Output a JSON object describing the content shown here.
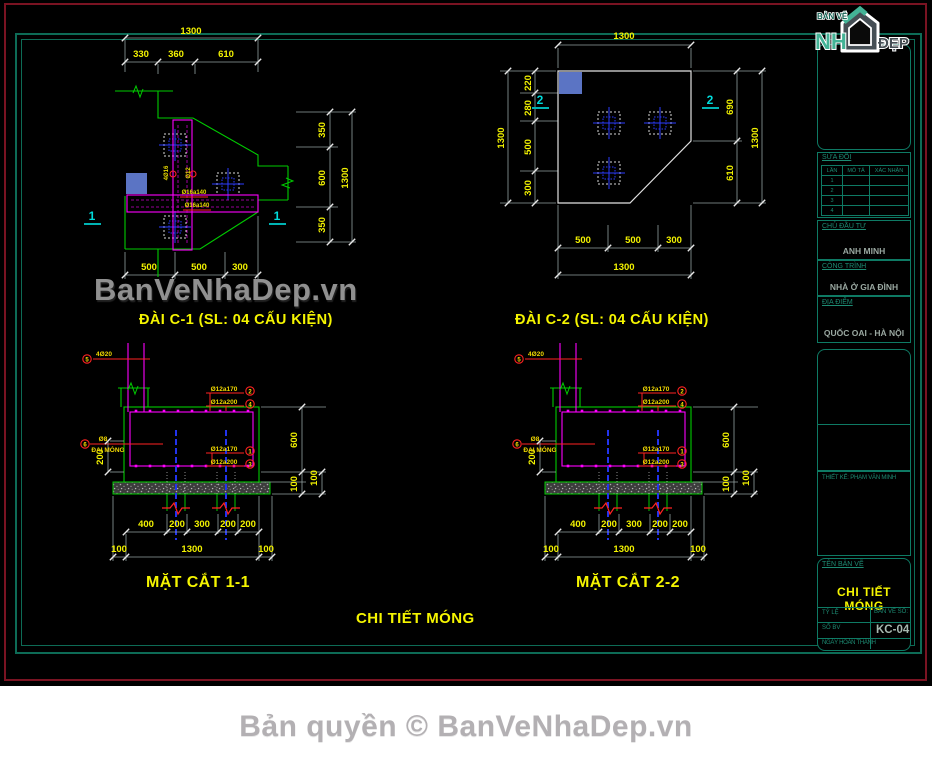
{
  "colors": {
    "line_green": "#00cc00",
    "magenta": "#ff00ff",
    "dim_text_yellow": "#f2f200",
    "cyan_marker": "#00dcdc",
    "blue_fill": "#5b74c4",
    "blue_line": "#2233ee",
    "red_callout": "#ff2222",
    "teal_frame": "#0d6b56",
    "maroon_frame": "#7a1322",
    "white_line": "#e2e2e2",
    "watermark_gray": "#909090"
  },
  "watermark": {
    "text": "BanVeNhaDep.vn"
  },
  "footer": {
    "copyright": "Bản quyền © BanVeNhaDep.vn"
  },
  "logo": {
    "top": "BẢN VẼ",
    "left": "NH",
    "right": "ĐẸP"
  },
  "main_title": "CHI TIẾT MÓNG",
  "c1": {
    "title": "ĐÀI C-1 (SL: 04 CẤU KIỆN)",
    "marker": "1",
    "top_total": "1300",
    "top_chain": [
      "330",
      "360",
      "610"
    ],
    "right_chain": [
      "350",
      "600",
      "350"
    ],
    "right_total": "1300",
    "bottom_chain": [
      "500",
      "500",
      "300"
    ],
    "bar_label_1": "4Ø16",
    "bar_label_2": "Ø12",
    "band_label_1": "Ø16a140",
    "band_label_2": "Ø16a140"
  },
  "c2": {
    "title": "ĐÀI C-2 (SL: 04 CẤU KIỆN)",
    "marker": "2",
    "top_total": "1300",
    "left_chain": [
      "220",
      "280",
      "500",
      "300"
    ],
    "left_total": "1300",
    "right_chain": [
      "690",
      "610"
    ],
    "right_total": "1300",
    "bottom_chain": [
      "500",
      "500",
      "300"
    ],
    "bottom_total": "1300"
  },
  "s11": {
    "title": "MẶT CẮT 1-1",
    "bottom_chain": [
      "400",
      "200",
      "300",
      "200",
      "200"
    ],
    "bottom_totals": [
      "100",
      "1300",
      "100"
    ],
    "left_dim": "200",
    "right_dims": [
      "600",
      "100",
      "100"
    ],
    "callouts_top": [
      {
        "label": "Ø12a170",
        "num": "2"
      },
      {
        "label": "Ø12a200",
        "num": "4"
      }
    ],
    "callouts_bottom": [
      {
        "label": "Ø12a170",
        "num": "1"
      },
      {
        "label": "Ø12a200",
        "num": "3"
      }
    ],
    "column_callout": {
      "num": "5",
      "label": "4Ø20"
    },
    "side_callout": {
      "num": "6",
      "label": "Ø8",
      "label2": "ĐAI MÓNG"
    }
  },
  "s22": {
    "title": "MẶT CẮT 2-2",
    "bottom_chain": [
      "400",
      "200",
      "300",
      "200",
      "200"
    ],
    "bottom_totals": [
      "100",
      "1300",
      "100"
    ],
    "left_dim": "200",
    "right_dims": [
      "600",
      "100",
      "100"
    ],
    "callouts_top": [
      {
        "label": "Ø12a170",
        "num": "2"
      },
      {
        "label": "Ø12a200",
        "num": "4"
      }
    ],
    "callouts_bottom": [
      {
        "label": "Ø12a170",
        "num": "1"
      },
      {
        "label": "Ø12a200",
        "num": "3"
      }
    ],
    "column_callout": {
      "num": "5",
      "label": "4Ø20"
    },
    "side_callout": {
      "num": "6",
      "label": "Ø8",
      "label2": "ĐAI MÓNG"
    }
  },
  "titleblock": {
    "revisions": {
      "header": "SỬA ĐỔI",
      "columns": [
        "LẦN",
        "MÔ TẢ",
        "XÁC NHẬN"
      ],
      "rows": [
        "1",
        "2",
        "3",
        "4"
      ]
    },
    "owner_label": "CHỦ ĐẦU TƯ",
    "owner": "ANH MINH",
    "project_label": "CÔNG TRÌNH",
    "project": "NHÀ Ở GIA ĐÌNH",
    "location_label": "ĐỊA ĐIỂM",
    "location": "QUỐC OAI - HÀ NỘI",
    "designer": "THIẾT KẾ: PHẠM VĂN MINH",
    "drawing_name_label": "TÊN BẢN VẼ",
    "drawing_name": "CHI TIẾT MÓNG",
    "scale_label": "TỶ LỆ",
    "number_label": "SỐ BV",
    "sheet_label": "BẢN VẼ SỐ:",
    "sheet_number": "KC-04",
    "date_label": "NGÀY HOÀN THÀNH"
  }
}
